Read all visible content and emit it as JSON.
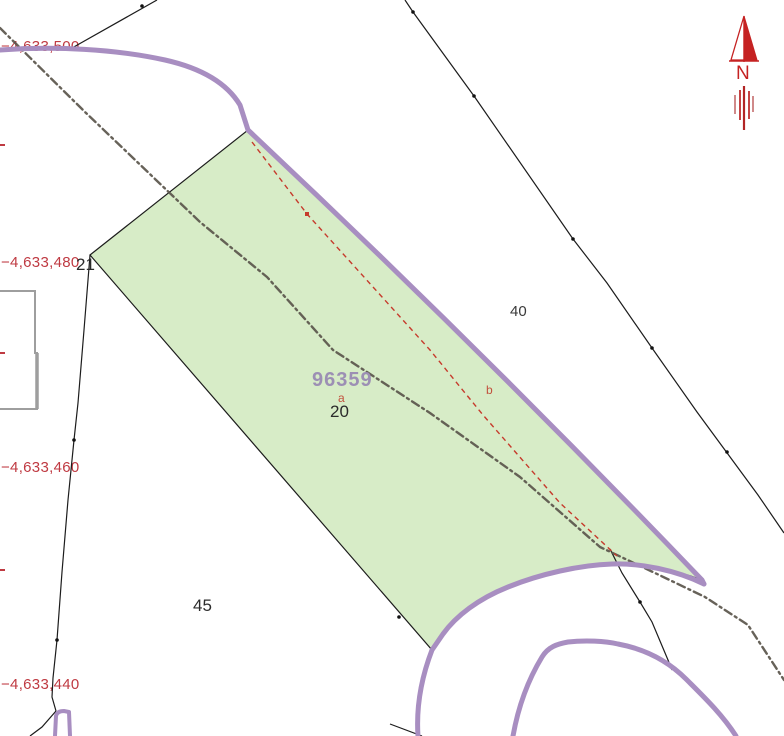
{
  "view": {
    "type": "cadastral-map",
    "background": "#ffffff"
  },
  "grid_labels": [
    {
      "text": "−4,633,500"
    },
    {
      "text": "−4,633,480"
    },
    {
      "text": "−4,633,460"
    },
    {
      "text": "−4,633,440"
    }
  ],
  "parcels": {
    "p21": "21",
    "p40": "40",
    "p45": "45"
  },
  "selected_parcel": {
    "id": "96359",
    "number": "20",
    "subparcel_a": "a",
    "subparcel_b": "b"
  },
  "north_arrow": {
    "label": "N"
  },
  "colors": {
    "parcel_fill": "#d7ecc7",
    "parcel_outline": "#1c1c1c",
    "road_edge": "#a88ec1",
    "track_line": "#5a554b",
    "survey_line": "#c63b2c",
    "grid_text": "#bf3a42",
    "selected_id_text": "#9c8fb4",
    "building_outline": "#9e9e9e",
    "north_arrow_red": "#c52222"
  }
}
